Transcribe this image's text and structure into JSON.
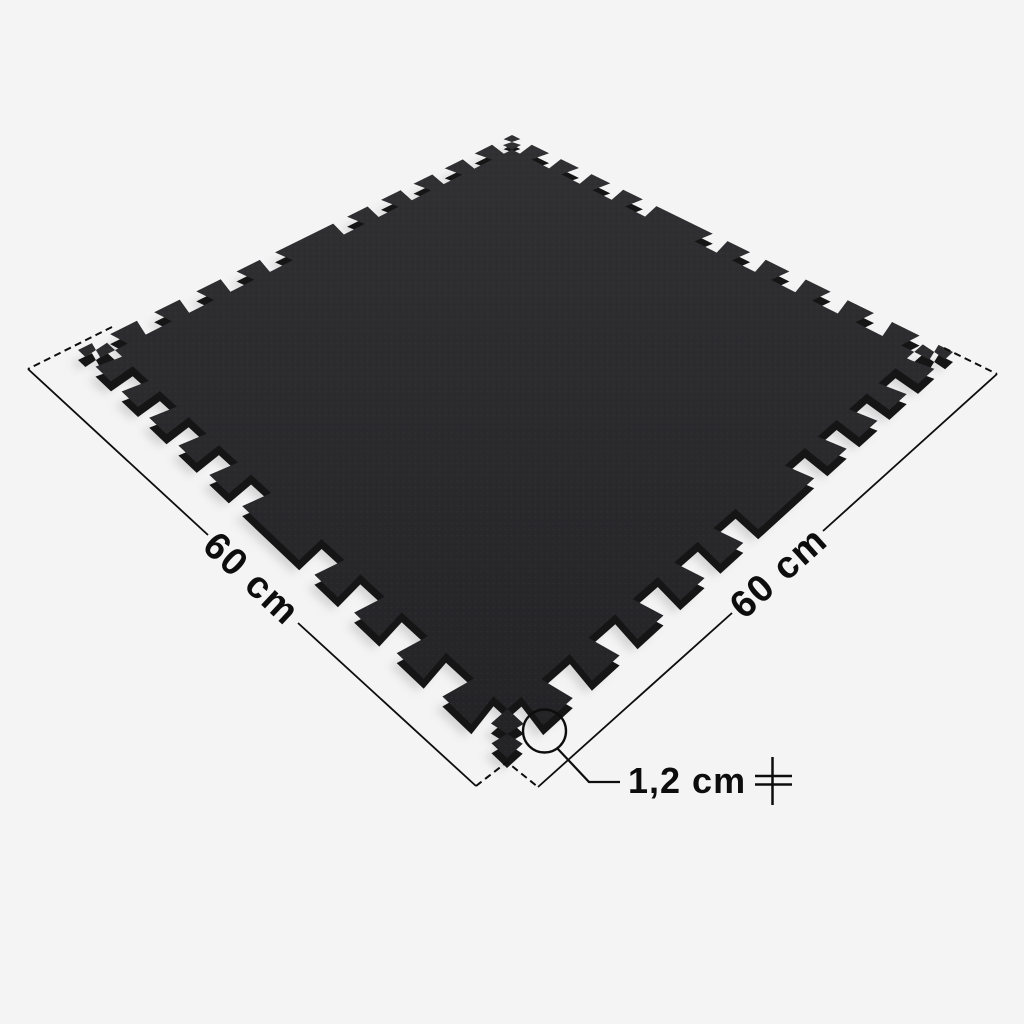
{
  "diagram": {
    "labels": {
      "side_left": "60 cm",
      "side_right": "60 cm",
      "thickness": "1,2 cm"
    },
    "colors": {
      "background": "#f4f4f4",
      "mat_face": "#2a2a2c",
      "mat_side": "#151515",
      "mat_shadow": "#d2d2d2",
      "annotation": "#0d0d0d"
    },
    "icons": {
      "thickness_icon": "thickness-gauge"
    }
  }
}
